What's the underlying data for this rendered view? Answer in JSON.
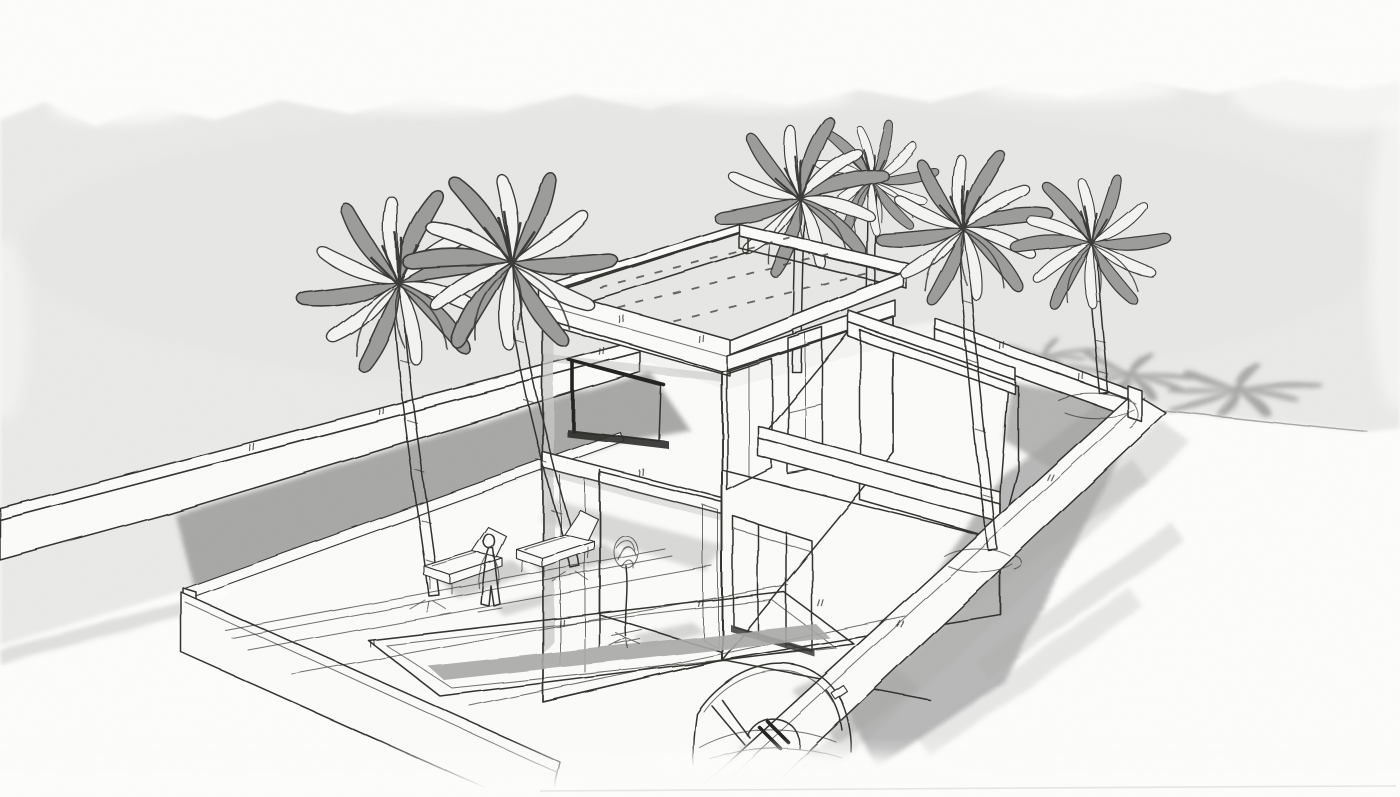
{
  "description": "Hand-drawn monochrome architect's perspective sketch of a modern two-storey flat-roof villa on a walled corner plot, with swimming-pool terrace, sun loungers, a standing figure, a potted sapling, six palm trees, palm shadows on the street and a car parked outside the wall; grey watercolour wash on textured paper; no text or UI widgets are visible in the image.",
  "palette": {
    "paper": "#fdfdfc",
    "plot_ground": "#fbfbf9",
    "wash": "#eaeae8",
    "shadow": "#a8a8a7",
    "wall_white": "#fbfbfa",
    "face_light": "#f2f2f0",
    "face_shade": "#a7a7a5",
    "terrace_shade": "#b2b2b0",
    "parapet_inner": "#ababa9",
    "glass": "#c8c8c6",
    "trunk": "#f3f3f1",
    "frond_gray": "#9c9c9a",
    "frond_light": "#f4f4f2",
    "line": "#32322f"
  },
  "scene": {
    "style": "hand-drawn perspective sketch, SketchUp-like linework over watercolour wash",
    "building": "two-storey flat-roof villa with picture window, covered porch, sliding glass door and single-storey roof-terrace wing",
    "site": "rectangular plot enclosed by low white perimeter wall, pool terrace inside, street on two sides",
    "features": [
      "gray-wash sky and ground",
      "torn-paper wash edges",
      "flat roof with parapet and dashed deck marks",
      "large picture window with heavy sill",
      "corner glazing",
      "sliding glass door",
      "roof-terrace wing with parapet",
      "perimeter wall",
      "swimming pool with coping",
      "paving joint lines",
      "sun loungers",
      "standing figure",
      "potted sapling",
      "palm trees",
      "star-shaped palm shadows",
      "large cast shadow wedge",
      "sketched car on street",
      "paper grain texture"
    ],
    "counts": {
      "palm_trees": 6,
      "palm_ground_shadows": 3,
      "sun_loungers": 2,
      "human_figures": 1,
      "cars": 1
    },
    "text_visible": "none"
  }
}
